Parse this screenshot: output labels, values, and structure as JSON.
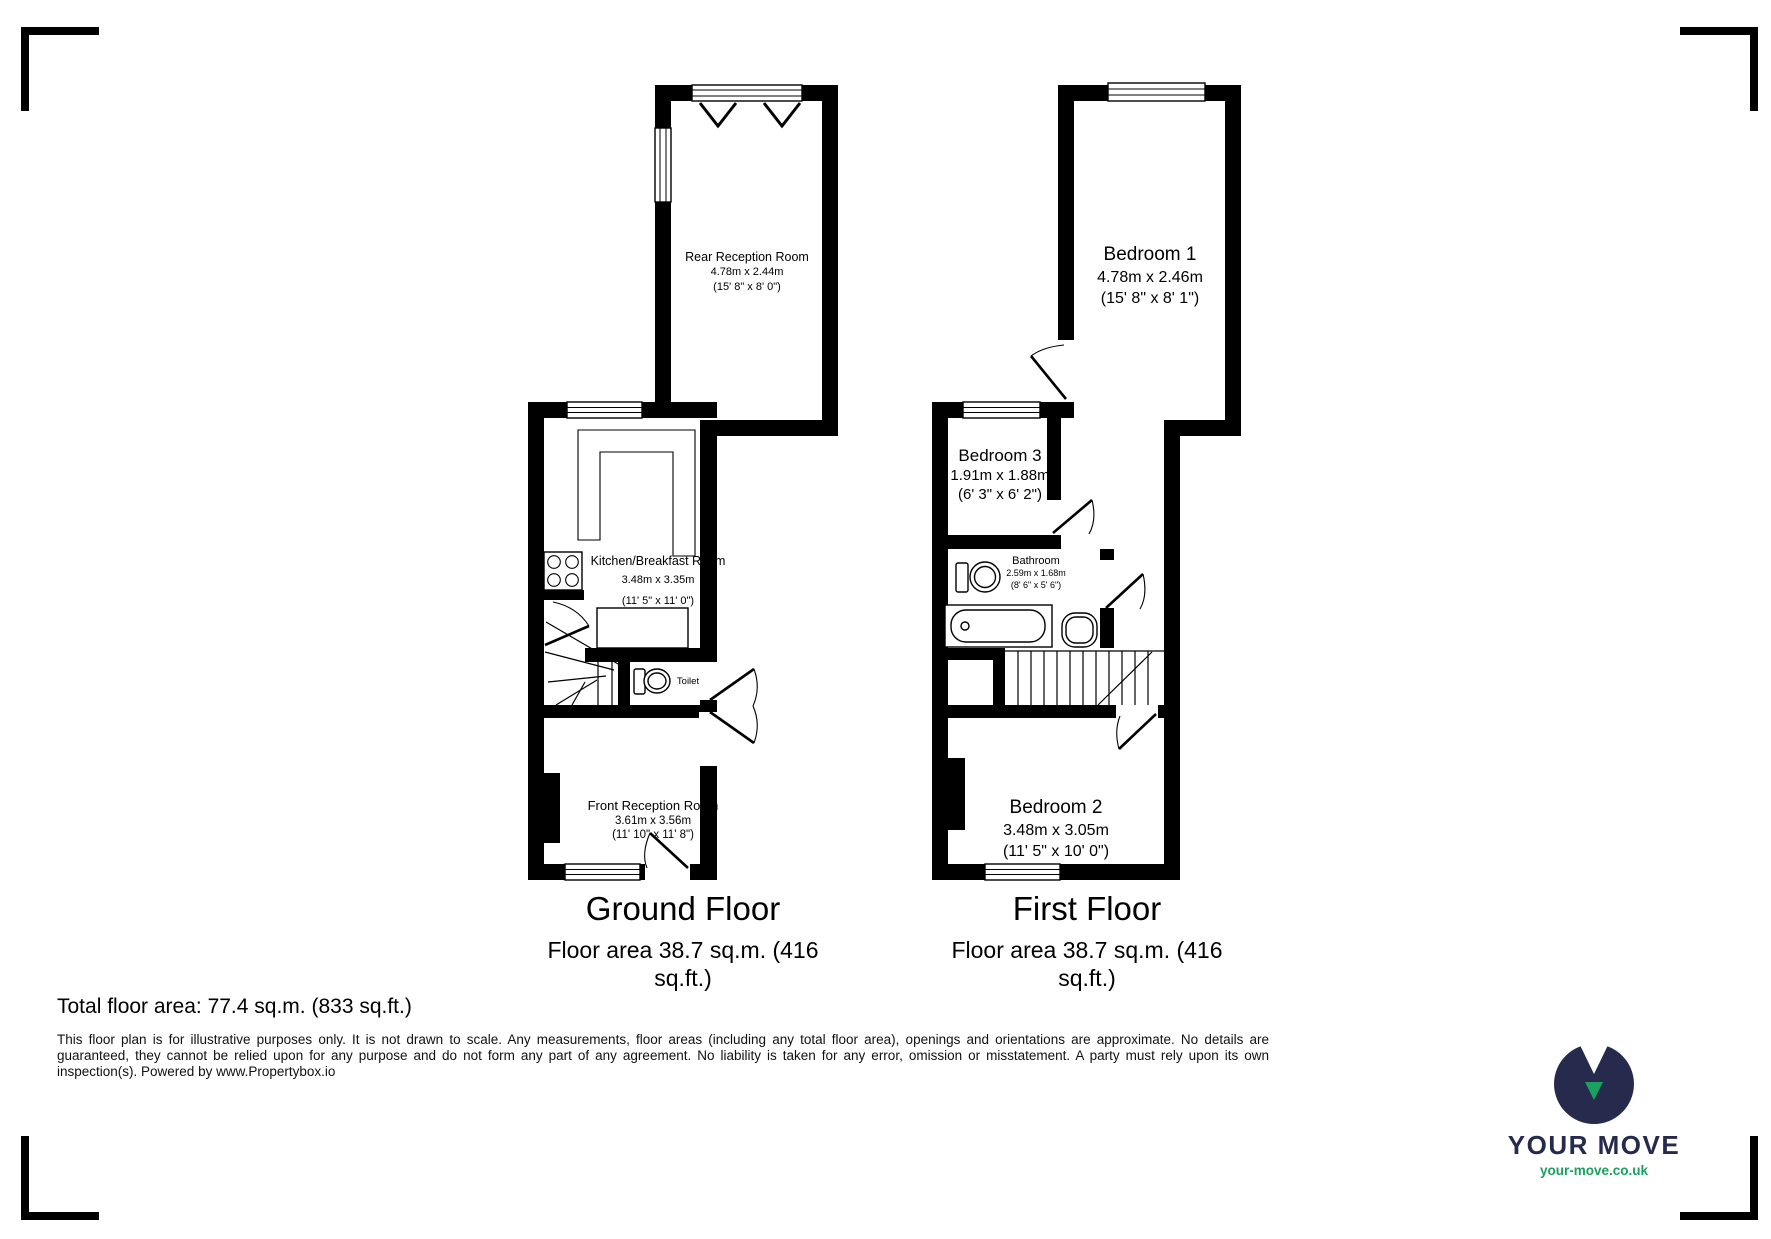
{
  "ground_floor": {
    "title": "Ground Floor",
    "area_line1": "Floor area 38.7 sq.m. (416",
    "area_line2": "sq.ft.)",
    "rooms": {
      "rear_reception": {
        "name": "Rear Reception Room",
        "metric": "4.78m x 2.44m",
        "imperial": "(15' 8\" x 8' 0\")"
      },
      "kitchen": {
        "name": "Kitchen/Breakfast Room",
        "metric": "3.48m x 3.35m",
        "imperial": "(11' 5\" x 11' 0\")"
      },
      "toilet": {
        "name": "Toilet"
      },
      "front_reception": {
        "name": "Front Reception Room",
        "metric": "3.61m x 3.56m",
        "imperial": "(11' 10\" x 11' 8\")"
      }
    }
  },
  "first_floor": {
    "title": "First Floor",
    "area_line1": "Floor area 38.7 sq.m. (416",
    "area_line2": "sq.ft.)",
    "rooms": {
      "bedroom1": {
        "name": "Bedroom 1",
        "metric": "4.78m x 2.46m",
        "imperial": "(15' 8\" x 8' 1\")"
      },
      "bedroom3": {
        "name": "Bedroom 3",
        "metric": "1.91m x 1.88m",
        "imperial": "(6' 3\" x 6' 2\")"
      },
      "bathroom": {
        "name": "Bathroom",
        "metric": "2.59m x 1.68m",
        "imperial": "(8' 6\" x 5' 6\")"
      },
      "bedroom2": {
        "name": "Bedroom 2",
        "metric": "3.48m x 3.05m",
        "imperial": "(11' 5\" x 10' 0\")"
      }
    }
  },
  "summary": {
    "total_area": "Total floor area: 77.4 sq.m. (833 sq.ft.)"
  },
  "disclaimer": "This floor plan is for illustrative purposes only. It is not drawn to scale. Any measurements, floor areas (including any total floor area), openings and orientations are approximate. No details are guaranteed, they cannot be relied upon for any purpose and do not form any part of any agreement. No liability is taken for any error, omission or misstatement. A party must rely upon its own inspection(s). Powered by www.Propertybox.io",
  "logo": {
    "brand": "YOUR MOVE",
    "url": "your-move.co.uk",
    "navy": "#262b4e",
    "teal": "#19a15f"
  }
}
